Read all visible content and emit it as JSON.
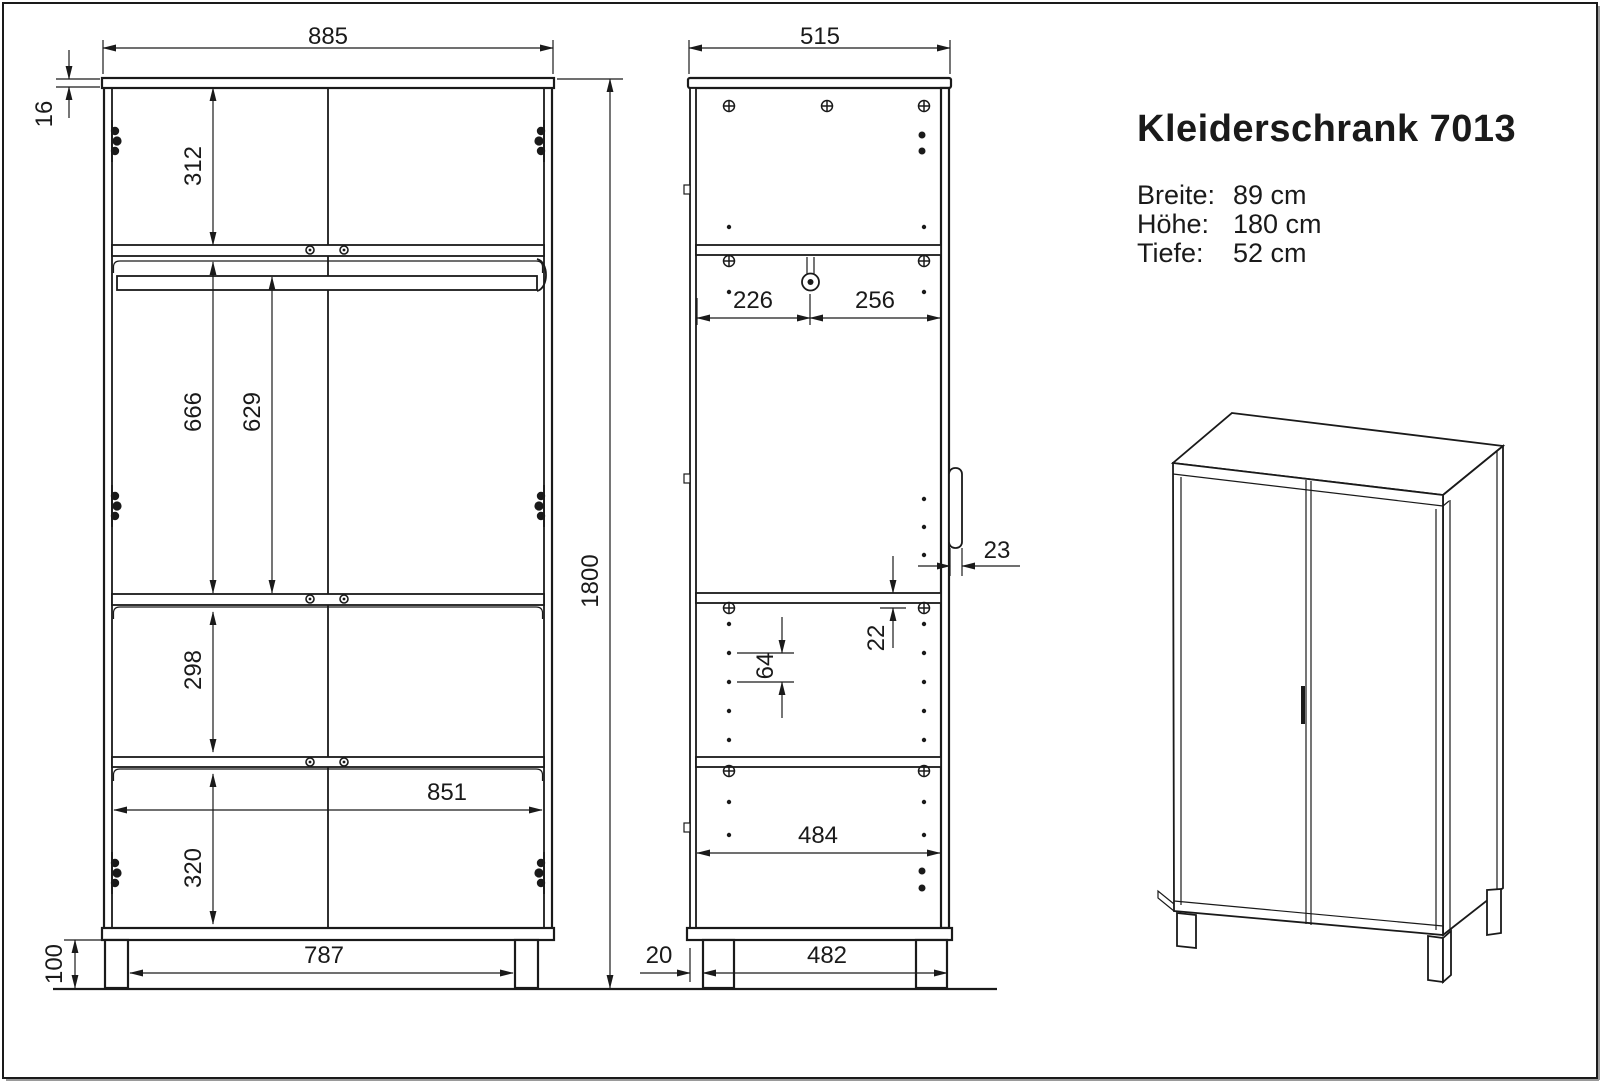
{
  "drawing": {
    "title": "Kleiderschrank 7013",
    "specs": [
      {
        "label": "Breite:",
        "value": "89 cm"
      },
      {
        "label": "Höhe:",
        "value": "180 cm"
      },
      {
        "label": "Tiefe:",
        "value": "52 cm"
      }
    ],
    "front_view": {
      "dims": {
        "width": "885",
        "top_thickness": "16",
        "top_section": "312",
        "rail_section": "666",
        "rail_height": "629",
        "mid_section": "298",
        "inner_width": "851",
        "bottom_section": "320",
        "plinth_width": "787",
        "leg_height": "100",
        "total_height": "1800"
      }
    },
    "side_view": {
      "dims": {
        "depth": "515",
        "rail_back": "226",
        "rail_front": "256",
        "handle_depth": "23",
        "shelf_offset": "22",
        "hole_spacing": "64",
        "inner_depth": "484",
        "leg_setback": "20",
        "leg_span": "482"
      }
    },
    "colors": {
      "line": "#1a1a1a",
      "background": "#ffffff"
    }
  }
}
